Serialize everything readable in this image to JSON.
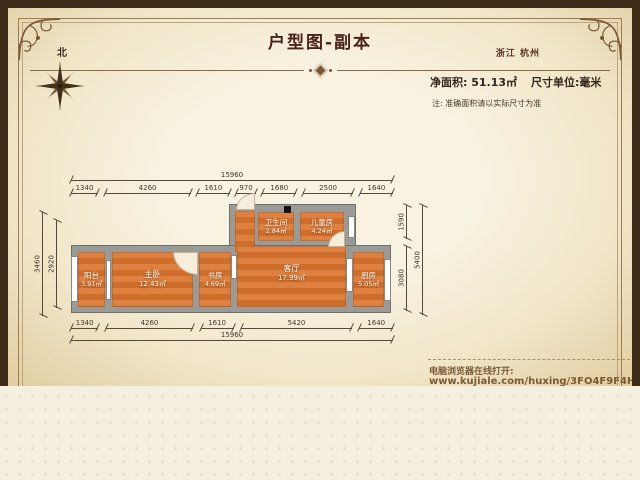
{
  "header": {
    "title": "户型图-副本",
    "location": "浙江 杭州",
    "area_label": "净面积: 51.13㎡",
    "unit_label": "尺寸单位:毫米",
    "note": "注: 准确面积请以实际尺寸为准",
    "compass_label": "北"
  },
  "footer": {
    "open_hint": "电脑浏览器在线打开:",
    "url": "www.kujiale.com/huxing/3FO4F9F4HNCN"
  },
  "plan": {
    "rooms": [
      {
        "name": "阳台",
        "area": "3.91㎡"
      },
      {
        "name": "主卧",
        "area": "12.43㎡"
      },
      {
        "name": "书房",
        "area": "4.69㎡"
      },
      {
        "name": "客厅",
        "area": "17.99㎡"
      },
      {
        "name": "厨房",
        "area": "5.05㎡"
      },
      {
        "name": "卫生间",
        "area": "2.84㎡"
      },
      {
        "name": "儿童房",
        "area": "4.24㎡"
      }
    ],
    "dims": {
      "top_total": [
        15960
      ],
      "top_segments": [
        1340,
        4260,
        1610,
        970,
        1680,
        2500,
        1640
      ],
      "bottom_segments": [
        1340,
        4260,
        1610,
        5420,
        1640
      ],
      "bottom_total": [
        15960
      ],
      "left_outer": [
        3460
      ],
      "left_inner": [
        2920
      ],
      "right_segments": [
        1590,
        3080
      ],
      "right_total": [
        5400
      ]
    }
  },
  "colors": {
    "floor": "#d9772f",
    "wall": "#9a9a96",
    "parchment": "#f6efdc",
    "frame_border": "#3e2c18",
    "title_text": "#4b2318",
    "link_text": "#7b5a32"
  }
}
